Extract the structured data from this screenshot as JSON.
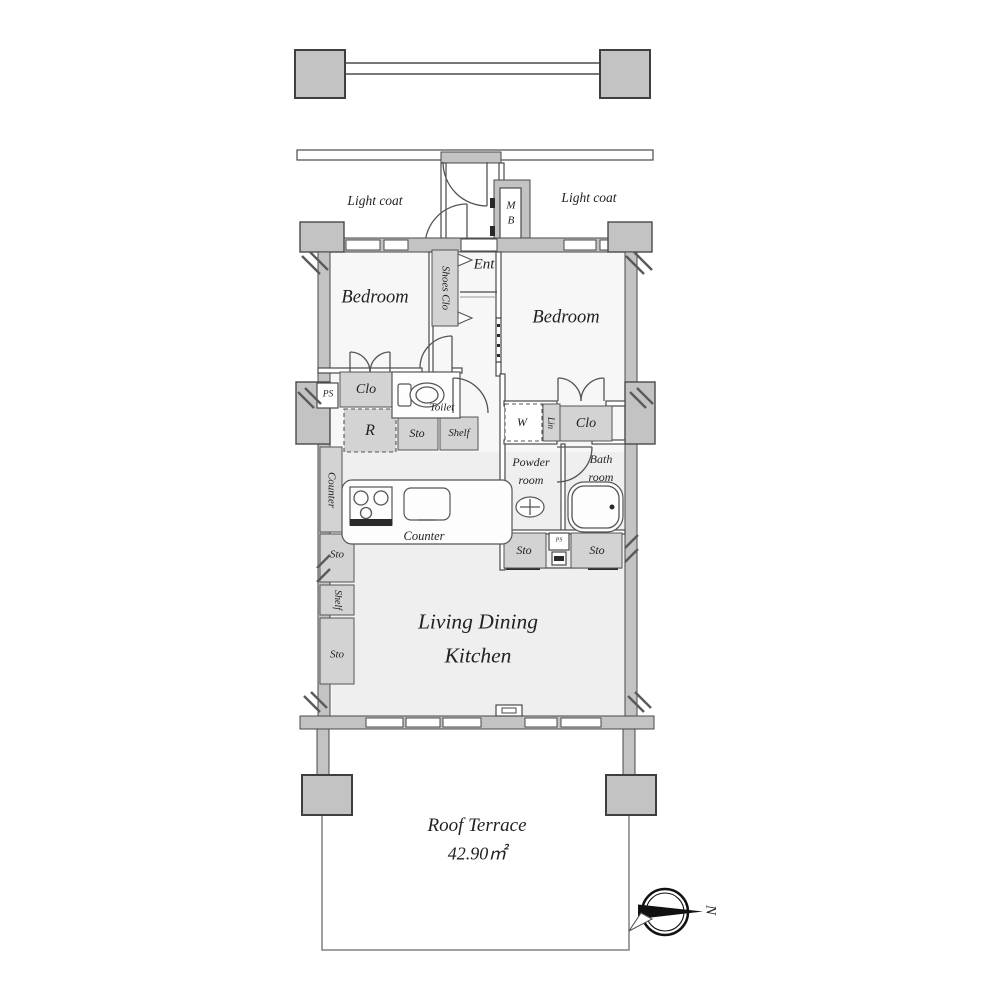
{
  "colors": {
    "wall": "#c3c3c3",
    "fixture": "#d3d3d3",
    "floor": "#f7f7f7",
    "floor2": "#efefef",
    "text": "#222222"
  },
  "labels": {
    "light_coat_left": "Light coat",
    "light_coat_right": "Light coat",
    "meter_box_m": "M",
    "meter_box_b": "B",
    "ent": "Ent",
    "shoes_clo": "Shoes Clo",
    "bedroom_left": "Bedroom",
    "bedroom_right": "Bedroom",
    "ps": "PS",
    "ps_small": "PS",
    "clo_left": "Clo",
    "toilet": "Toilet",
    "refrigerator": "R",
    "sto_kitchen": "Sto",
    "shelf_kitchen": "Shelf",
    "washer": "W",
    "linen": "Lin",
    "clo_right": "Clo",
    "counter_side": "Counter",
    "powder_room_line1": "Powder",
    "powder_room_line2": "room",
    "bath_room_line1": "Bath",
    "bath_room_line2": "room",
    "counter_front": "Counter",
    "sto_wash_left": "Sto",
    "sto_wash_right": "Sto",
    "sto_wall_top": "Sto",
    "shelf_wall": "Shelf",
    "sto_wall_bottom": "Sto",
    "ldk_line1": "Living Dining",
    "ldk_line2": "Kitchen",
    "roof_terrace": "Roof Terrace",
    "roof_terrace_area": "42.90㎡",
    "compass_north": "N"
  }
}
